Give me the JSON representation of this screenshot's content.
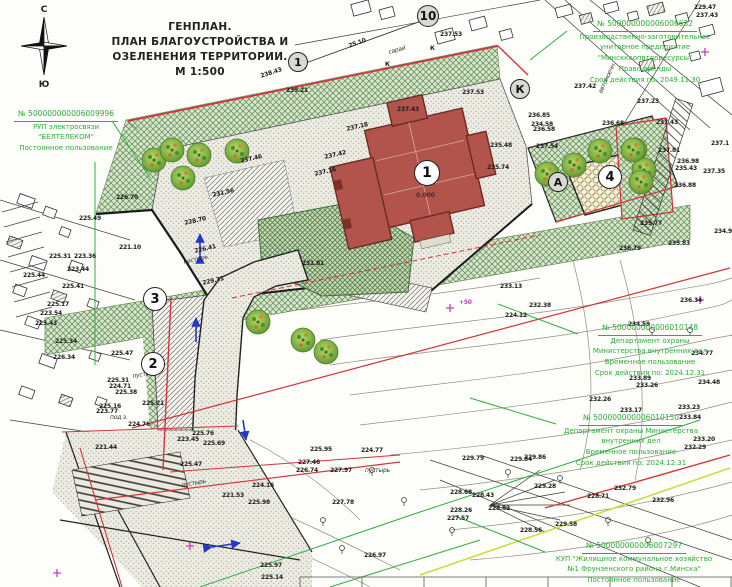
{
  "title": {
    "lines": [
      "ГЕНПЛАН.",
      "ПЛАН БЛАГОУСТРОЙСТВА И",
      "ОЗЕЛЕНЕНИЯ ТЕРРИТОРИИ.",
      "М 1:500"
    ]
  },
  "compass": {
    "north": "С",
    "south": "Ю"
  },
  "building": {
    "number": "1",
    "level_mark": "0.000"
  },
  "dimension_label": "25.10",
  "colors": {
    "annotation_green": "#2fae3c",
    "boundary_red": "#d2353a",
    "building_fill": "#b2544b",
    "arrow_blue": "#2038cc",
    "magenta": "#c13fc1"
  },
  "parcels": [
    {
      "number": "№ 500000000006009996",
      "lines": [
        "РУП электросвязи",
        "\"БЕЛТЕЛЕКОМ\"",
        "Постоянное пользование"
      ],
      "x": 0,
      "y": 108,
      "w": 132
    },
    {
      "number": "№ 500000000006006632",
      "lines": [
        "Производственно-заготовительное",
        "унитарное предприятие",
        "\"Минсккоопвторресурсы\"",
        "Право аренды",
        "Срок действия по: 2049.11.30"
      ],
      "x": 560,
      "y": 18,
      "w": 170
    },
    {
      "number": "№ 500000000006010148",
      "lines": [
        "Департамент охраны",
        "Министерства внутренних дел",
        "Временное пользование",
        "Срок действия по: 2024.12.31"
      ],
      "x": 570,
      "y": 322,
      "w": 160
    },
    {
      "number": "№ 500000000006010150",
      "lines": [
        "Департамент охраны Министерства",
        "внутренних дел",
        "Временное пользование",
        "Срок действия по: 2024.12.31"
      ],
      "x": 536,
      "y": 412,
      "w": 190
    },
    {
      "number": "№ 500000000006007297",
      "lines": [
        "КУП \"Жилищное коммунальное хозяйство",
        "№1 Фрунзенского района г.Минска\"",
        "Постоянное пользование"
      ],
      "x": 536,
      "y": 540,
      "w": 196
    }
  ],
  "markers": [
    {
      "label": "1",
      "x": 298,
      "y": 62,
      "r": 10,
      "fill": "#d9d9d3"
    },
    {
      "label": "10",
      "x": 428,
      "y": 16,
      "r": 11,
      "fill": "#d9d9d3"
    },
    {
      "label": "1",
      "x": 427,
      "y": 173,
      "r": 13,
      "fill": "#ffffff"
    },
    {
      "label": "3",
      "x": 155,
      "y": 299,
      "r": 12,
      "fill": "#ffffff"
    },
    {
      "label": "2",
      "x": 153,
      "y": 364,
      "r": 12,
      "fill": "#ffffff"
    },
    {
      "label": "К",
      "x": 520,
      "y": 89,
      "r": 10,
      "fill": "#d9d9d3"
    },
    {
      "label": "А",
      "x": 558,
      "y": 182,
      "r": 10,
      "fill": "#d9d9d3"
    },
    {
      "label": "4",
      "x": 610,
      "y": 177,
      "r": 12,
      "fill": "#ffffff"
    }
  ],
  "map_labels": [
    {
      "t": "25.10",
      "x": 348,
      "y": 44,
      "r": -20
    },
    {
      "t": "238.43",
      "x": 260,
      "y": 74,
      "r": -18
    },
    {
      "t": "239.21",
      "x": 286,
      "y": 88
    },
    {
      "t": "сарай",
      "x": 388,
      "y": 50,
      "r": -15,
      "k": "w"
    },
    {
      "t": "К",
      "x": 385,
      "y": 62
    },
    {
      "t": "К",
      "x": 430,
      "y": 46
    },
    {
      "t": "237.53",
      "x": 440,
      "y": 32
    },
    {
      "t": "229.47",
      "x": 694,
      "y": 5
    },
    {
      "t": "237.43",
      "x": 696,
      "y": 13
    },
    {
      "t": "237.42",
      "x": 574,
      "y": 84
    },
    {
      "t": "автомоечн.",
      "x": 598,
      "y": 92,
      "r": -65,
      "k": "w"
    },
    {
      "t": "237.53",
      "x": 462,
      "y": 90
    },
    {
      "t": "236.85",
      "x": 528,
      "y": 113
    },
    {
      "t": "236.58",
      "x": 533,
      "y": 127
    },
    {
      "t": "237.54",
      "x": 536,
      "y": 144
    },
    {
      "t": "235.48",
      "x": 490,
      "y": 143
    },
    {
      "t": "235.74",
      "x": 487,
      "y": 165
    },
    {
      "t": "234.58",
      "x": 531,
      "y": 122
    },
    {
      "t": "236.68",
      "x": 602,
      "y": 121
    },
    {
      "t": "237.43",
      "x": 397,
      "y": 107
    },
    {
      "t": "237.18",
      "x": 346,
      "y": 127,
      "r": -13
    },
    {
      "t": "237.46",
      "x": 240,
      "y": 159,
      "r": -13
    },
    {
      "t": "237.42",
      "x": 324,
      "y": 155,
      "r": -13
    },
    {
      "t": "237.16",
      "x": 314,
      "y": 172,
      "r": -13
    },
    {
      "t": "231.56",
      "x": 212,
      "y": 193,
      "r": -13
    },
    {
      "t": "228.70",
      "x": 184,
      "y": 221,
      "r": -13
    },
    {
      "t": "226.41",
      "x": 194,
      "y": 249,
      "r": -13
    },
    {
      "t": "пустырь",
      "x": 183,
      "y": 260,
      "r": -13,
      "k": "w"
    },
    {
      "t": "231.81",
      "x": 302,
      "y": 261
    },
    {
      "t": "229.31",
      "x": 202,
      "y": 281,
      "r": -13
    },
    {
      "t": "226.70",
      "x": 116,
      "y": 195
    },
    {
      "t": "225.49",
      "x": 79,
      "y": 216
    },
    {
      "t": "221.10",
      "x": 119,
      "y": 245
    },
    {
      "t": "225.31",
      "x": 49,
      "y": 254
    },
    {
      "t": "223.36",
      "x": 74,
      "y": 254
    },
    {
      "t": "223.44",
      "x": 67,
      "y": 267
    },
    {
      "t": "225.44",
      "x": 23,
      "y": 273
    },
    {
      "t": "225.41",
      "x": 62,
      "y": 284
    },
    {
      "t": "225.17",
      "x": 47,
      "y": 302
    },
    {
      "t": "223.54",
      "x": 40,
      "y": 311
    },
    {
      "t": "225.43",
      "x": 35,
      "y": 321
    },
    {
      "t": "225.34",
      "x": 55,
      "y": 339
    },
    {
      "t": "226.34",
      "x": 53,
      "y": 355
    },
    {
      "t": "225.47",
      "x": 111,
      "y": 351
    },
    {
      "t": "225.31",
      "x": 107,
      "y": 378
    },
    {
      "t": "224.71",
      "x": 109,
      "y": 384
    },
    {
      "t": "225.38",
      "x": 115,
      "y": 390
    },
    {
      "t": "225.16",
      "x": 99,
      "y": 404
    },
    {
      "t": "225.21",
      "x": 142,
      "y": 401
    },
    {
      "t": "223.77",
      "x": 96,
      "y": 409
    },
    {
      "t": "под з.",
      "x": 110,
      "y": 415,
      "k": "w"
    },
    {
      "t": "224.76",
      "x": 128,
      "y": 422
    },
    {
      "t": "пустырь",
      "x": 132,
      "y": 374,
      "r": -10,
      "k": "w"
    },
    {
      "t": "221.44",
      "x": 95,
      "y": 445
    },
    {
      "t": "225.76",
      "x": 192,
      "y": 431
    },
    {
      "t": "223.45",
      "x": 177,
      "y": 437
    },
    {
      "t": "225.69",
      "x": 203,
      "y": 441
    },
    {
      "t": "225.47",
      "x": 180,
      "y": 462
    },
    {
      "t": "пустырь",
      "x": 181,
      "y": 483,
      "r": -10,
      "k": "w"
    },
    {
      "t": "224.16",
      "x": 252,
      "y": 483
    },
    {
      "t": "221.53",
      "x": 222,
      "y": 493
    },
    {
      "t": "225.98",
      "x": 248,
      "y": 500
    },
    {
      "t": "225.95",
      "x": 310,
      "y": 447
    },
    {
      "t": "227.46",
      "x": 298,
      "y": 460
    },
    {
      "t": "226.74",
      "x": 296,
      "y": 468
    },
    {
      "t": "227.97",
      "x": 330,
      "y": 468
    },
    {
      "t": "224.77",
      "x": 361,
      "y": 448
    },
    {
      "t": "пустырь",
      "x": 365,
      "y": 468,
      "k": "w"
    },
    {
      "t": "227.78",
      "x": 332,
      "y": 500
    },
    {
      "t": "226.97",
      "x": 364,
      "y": 553
    },
    {
      "t": "225.97",
      "x": 260,
      "y": 563
    },
    {
      "t": "225.14",
      "x": 261,
      "y": 575
    },
    {
      "t": "229.79",
      "x": 462,
      "y": 456
    },
    {
      "t": "229.84",
      "x": 510,
      "y": 457
    },
    {
      "t": "229.28",
      "x": 534,
      "y": 484
    },
    {
      "t": "228.68",
      "x": 450,
      "y": 490
    },
    {
      "t": "228.43",
      "x": 472,
      "y": 493
    },
    {
      "t": "228.62",
      "x": 488,
      "y": 506
    },
    {
      "t": "228.26",
      "x": 450,
      "y": 508
    },
    {
      "t": "227.57",
      "x": 447,
      "y": 516
    },
    {
      "t": "232.79",
      "x": 614,
      "y": 486
    },
    {
      "t": "228.71",
      "x": 587,
      "y": 494
    },
    {
      "t": "232.96",
      "x": 652,
      "y": 498
    },
    {
      "t": "229.58",
      "x": 555,
      "y": 522
    },
    {
      "t": "228.56",
      "x": 520,
      "y": 528
    },
    {
      "t": "233.13",
      "x": 500,
      "y": 284
    },
    {
      "t": "232.38",
      "x": 529,
      "y": 303
    },
    {
      "t": "224.12",
      "x": 505,
      "y": 313
    },
    {
      "t": "234.59",
      "x": 628,
      "y": 322
    },
    {
      "t": "234.77",
      "x": 691,
      "y": 351
    },
    {
      "t": "233.89",
      "x": 629,
      "y": 376
    },
    {
      "t": "233.26",
      "x": 636,
      "y": 383
    },
    {
      "t": "234.48",
      "x": 698,
      "y": 380
    },
    {
      "t": "232.26",
      "x": 589,
      "y": 397
    },
    {
      "t": "233.17",
      "x": 620,
      "y": 408
    },
    {
      "t": "233.23",
      "x": 678,
      "y": 405
    },
    {
      "t": "233.84",
      "x": 679,
      "y": 415
    },
    {
      "t": "233.20",
      "x": 693,
      "y": 437
    },
    {
      "t": "232.29",
      "x": 684,
      "y": 445
    },
    {
      "t": "229.86",
      "x": 524,
      "y": 455
    },
    {
      "t": "237.23",
      "x": 637,
      "y": 99
    },
    {
      "t": "237.43",
      "x": 656,
      "y": 120
    },
    {
      "t": "237.1",
      "x": 711,
      "y": 141
    },
    {
      "t": "237.81",
      "x": 658,
      "y": 148
    },
    {
      "t": "236.98",
      "x": 677,
      "y": 159
    },
    {
      "t": "235.43",
      "x": 675,
      "y": 166
    },
    {
      "t": "237.35",
      "x": 703,
      "y": 169
    },
    {
      "t": "236.88",
      "x": 674,
      "y": 183
    },
    {
      "t": "235.77",
      "x": 640,
      "y": 221
    },
    {
      "t": "235.83",
      "x": 668,
      "y": 241
    },
    {
      "t": "234.98",
      "x": 714,
      "y": 229
    },
    {
      "t": "236.79",
      "x": 619,
      "y": 246
    },
    {
      "t": "236.34",
      "x": 680,
      "y": 298
    },
    {
      "t": "+50",
      "x": 459,
      "y": 300,
      "c": "m"
    }
  ]
}
